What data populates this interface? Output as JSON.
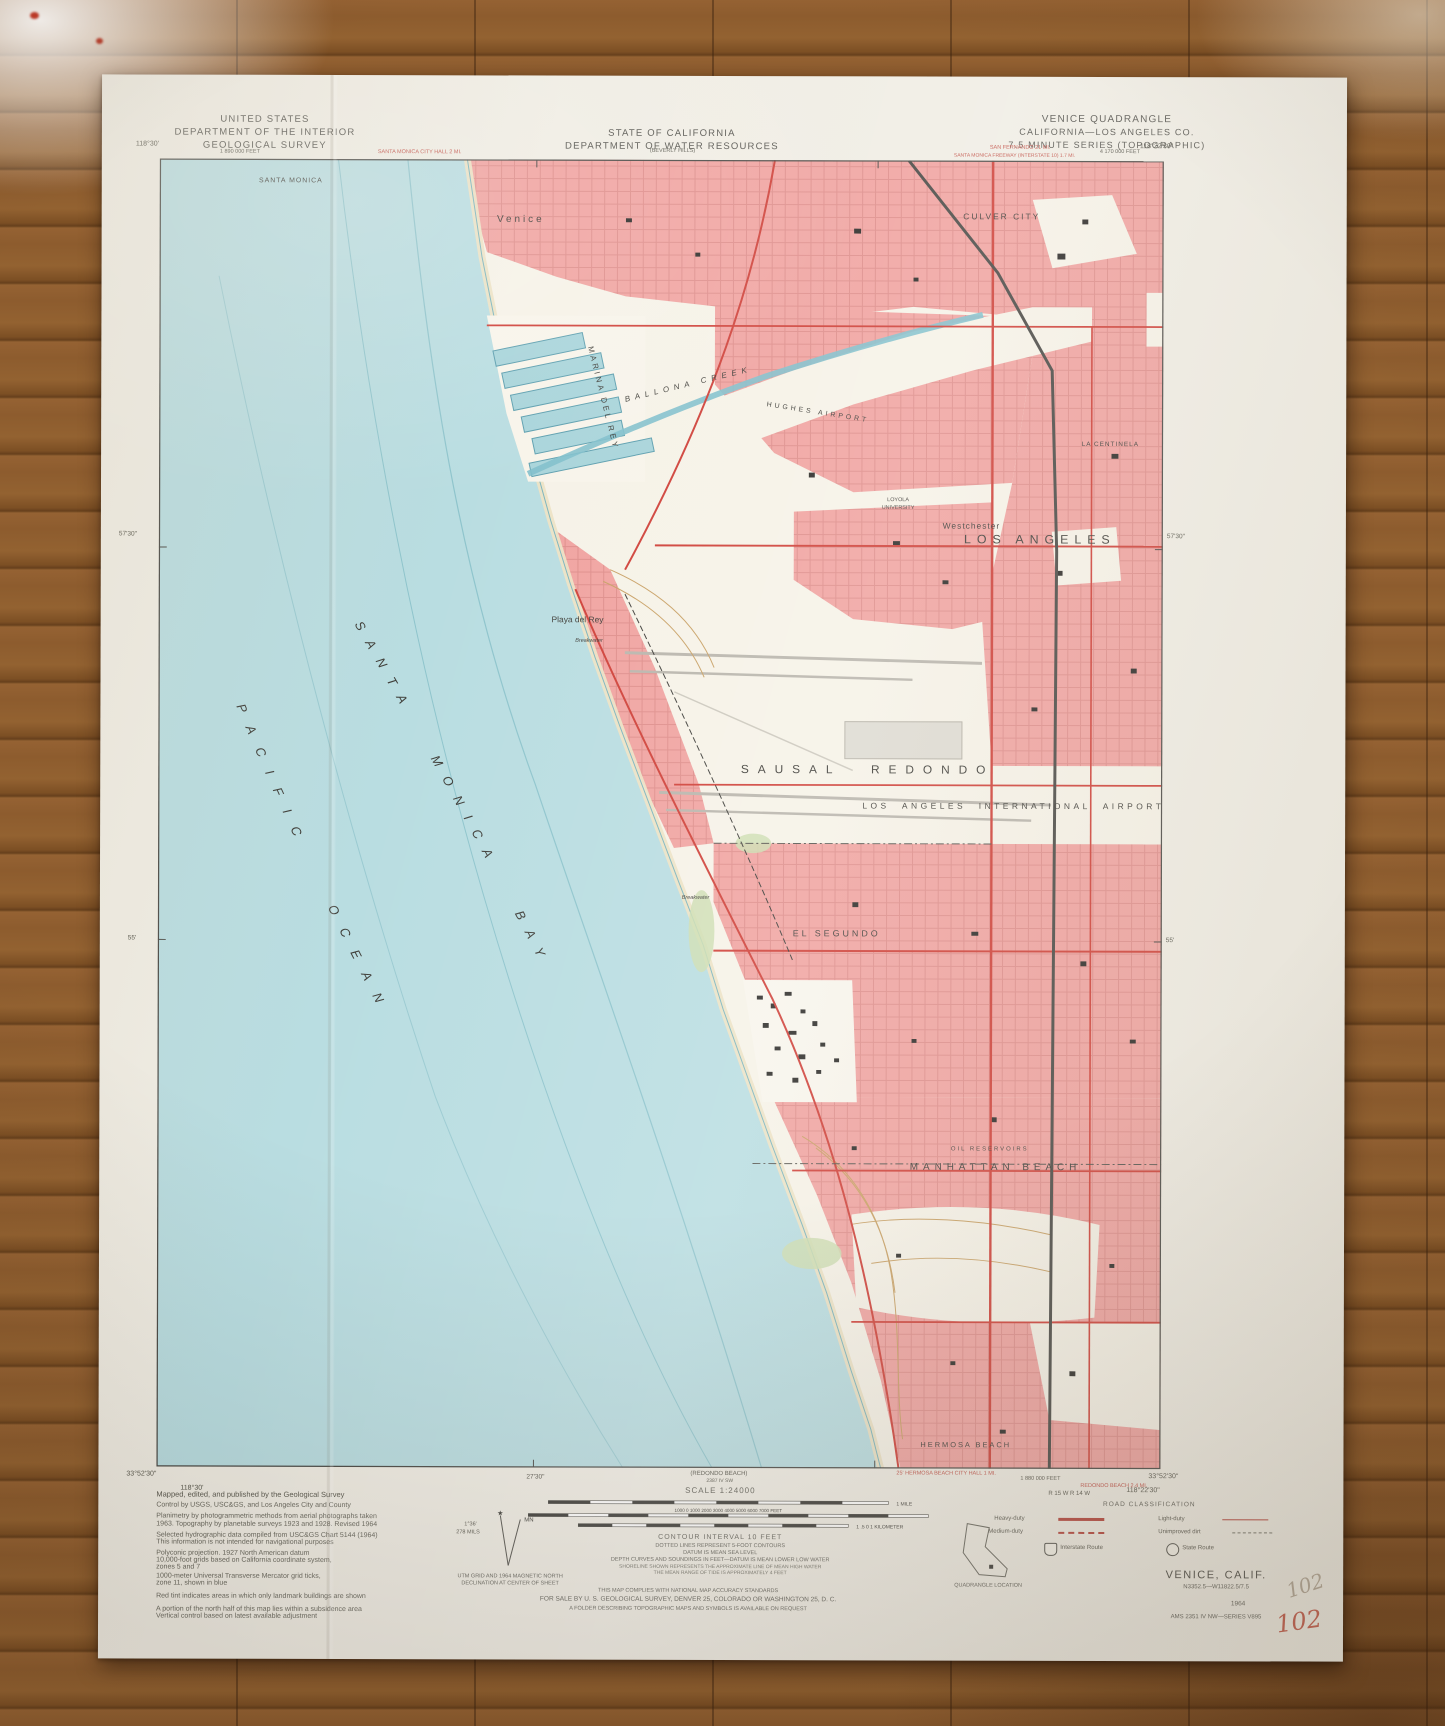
{
  "photo": {
    "handwritten_pencil": "102",
    "handwritten_red": "102"
  },
  "header": {
    "agency": [
      "UNITED STATES",
      "DEPARTMENT OF THE INTERIOR",
      "GEOLOGICAL SURVEY"
    ],
    "state": [
      "STATE OF CALIFORNIA",
      "DEPARTMENT OF WATER RESOURCES"
    ],
    "quad": [
      "VENICE QUADRANGLE",
      "CALIFORNIA—LOS ANGELES CO.",
      "7.5 MINUTE SERIES (TOPOGRAPHIC)"
    ]
  },
  "map": {
    "labels": {
      "santa_monica": "SANTA MONICA",
      "venice": "Venice",
      "culver_city": "CULVER CITY",
      "ballona_creek": "BALLONA CREEK",
      "marina_del_rey": "MARINA DEL REY",
      "hughes_airport": "HUGHES AIRPORT",
      "loyola1": "LOYOLA",
      "loyola2": "UNIVERSITY",
      "los_angeles": "LOS ANGELES",
      "westchester": "Westchester",
      "la_centinela": "LA CENTINELA",
      "playa_del_rey": "Playa del Rey",
      "breakwater1": "Breakwater",
      "breakwater2": "Breakwater",
      "lax": "LOS ANGELES INTERNATIONAL AIRPORT",
      "sausal_redondo": "SAUSAL REDONDO",
      "el_segundo": "EL SEGUNDO",
      "oil_reservoirs": "OIL RESERVOIRS",
      "manhattan_beach": "MANHATTAN BEACH",
      "hermosa_beach": "HERMOSA BEACH",
      "bay": "SANTA MONICA BAY",
      "ocean": "PACIFIC OCEAN"
    },
    "margin": {
      "top_left_coord": "118°30'",
      "top_feet": "1 890 000 FEET",
      "santa_monica_city_hall": "SANTA MONICA CITY HALL 2 MI.",
      "beverly_hills": "(BEVERLY HILLS)",
      "san_fernando": "SAN FERNANDO 21 MI.",
      "santa_monica_freeway": "SANTA MONICA FREEWAY (INTERSTATE 10) 1.7 MI.",
      "top_right_feet": "4 170 000 FEET",
      "top_right_coord": "118°22'30\"",
      "right_5730": "57'30\"",
      "right_55": "55'",
      "left_5730": "57'30\"",
      "left_55": "55'",
      "bottom_left_lat": "33°52'30\"",
      "bottom_left_lon": "118°30'",
      "bottom_2730": "27'30\"",
      "redondo_ref": "(REDONDO BEACH)",
      "redondo_ref2": "2387 IV SW",
      "hermosa_city_hall": "25' HERMOSA BEACH CITY HALL 1 MI.",
      "feet_1880": "1 880 000 FEET",
      "redondo_mi": "REDONDO BEACH 2.4 MI.",
      "range_labels": "R 15 W   R 14 W",
      "bottom_right_lat": "33°52'30\"",
      "bottom_right_lon": "118°22'30\""
    }
  },
  "footer": {
    "credits": [
      "Mapped, edited, and published by the Geological Survey",
      "Control by USGS, USC&GS, and Los Angeles City and County",
      "Planimetry by photogrammetric methods from aerial photographs taken",
      "1963.  Topography by planetable surveys 1923 and 1928.  Revised 1964",
      "Selected hydrographic data compiled from USC&GS Chart 5144 (1964)",
      "This information is not intended for navigational purposes",
      "Polyconic projection.  1927 North American datum",
      "10,000-foot grids based on California coordinate system,",
      "zones 5 and 7",
      "1000-meter Universal Transverse Mercator grid ticks,",
      "zone 11, shown in blue",
      "Red tint indicates areas in which only landmark buildings are shown",
      "A portion of the north half of this map lies within a subsidence area",
      "Vertical control based on latest available adjustment"
    ],
    "declination": {
      "caption1": "UTM GRID AND 1964 MAGNETIC NORTH",
      "caption2": "DECLINATION AT CENTER OF SHEET",
      "angle": "1°36'",
      "mils": "278 MILS"
    },
    "scale": {
      "label": "SCALE 1:24000",
      "miles": "1 MILE",
      "feet": "1000 0 1000 2000 3000 4000 5000 6000 7000 FEET",
      "km": "1 .5 0 1 KILOMETER"
    },
    "notes": [
      "CONTOUR INTERVAL 10 FEET",
      "DOTTED LINES REPRESENT 5-FOOT CONTOURS",
      "DATUM IS MEAN SEA LEVEL",
      "DEPTH CURVES AND SOUNDINGS IN FEET—DATUM IS MEAN LOWER LOW WATER",
      "SHORELINE SHOWN REPRESENTS THE APPROXIMATE LINE OF MEAN HIGH WATER",
      "THE MEAN RANGE OF TIDE IS APPROXIMATELY 4 FEET"
    ],
    "accuracy": "THIS MAP COMPLIES WITH NATIONAL MAP ACCURACY STANDARDS",
    "sale": "FOR SALE BY U. S. GEOLOGICAL SURVEY, DENVER 25, COLORADO OR WASHINGTON 25, D. C.",
    "folder": "A FOLDER DESCRIBING TOPOGRAPHIC MAPS AND SYMBOLS IS AVAILABLE ON REQUEST",
    "quad_location": "QUADRANGLE LOCATION",
    "road_class": {
      "title": "ROAD CLASSIFICATION",
      "heavy": "Heavy-duty",
      "medium": "Medium-duty",
      "light": "Light-duty",
      "unimproved": "Unimproved dirt",
      "interstate": "Interstate Route",
      "state": "State Route"
    },
    "title": {
      "name": "VENICE, CALIF.",
      "coords": "N3352.5—W11822.5/7.5",
      "year": "1964",
      "series": "AMS 2351 IV NW—SERIES V895"
    }
  },
  "colors": {
    "wood": "#8a5a2c",
    "paper": "#f0ede4",
    "ocean": "#b9dde1",
    "urban_pink": "#f0a3a0",
    "road_red": "#cf4038",
    "water_blue": "#7fbfcb"
  }
}
